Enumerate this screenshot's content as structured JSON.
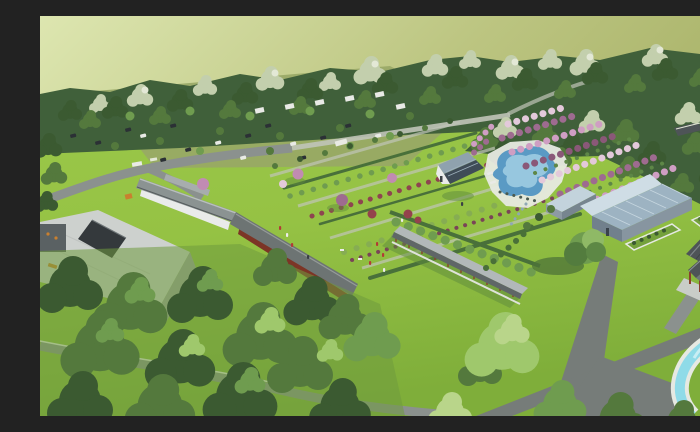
{
  "scene": {
    "type": "aerial-architectural-rendering",
    "description": "Bird's-eye architectural rendering of a landscaped park resort: pale olive sky haze, dense tree belt with wooded parking grove, formal lawn gardens with diagonal hedge and flower rows, kidney-shaped swimming pool surrounded by rows of pink and mauve flowering shrubs, gray flat-roof hall with dark courtyard opening, traditional tiled-roof corridor buildings, blue-gray gabled greenhouse hall, long covered walkway with red posts, red-column pavilion, curving cyan stream pool at lower right, and large green tree canopies at lower left.",
    "visible_text": []
  },
  "palette": {
    "hazeLight": "#dde6b0",
    "hazeMid": "#bcc581",
    "hazeDark": "#a6b065",
    "treeDark": "#3b5a31",
    "treeMid": "#54793d",
    "leafLight": "#6f9c4f",
    "canopyBright": "#9fc86c",
    "canopyPale": "#b9d58a",
    "sage": "#c3cfad",
    "sageLight": "#e3e8d6",
    "forestBase": "#40603a",
    "lawnBright": "#a5d14e",
    "lawnMid": "#8dbc3e",
    "lawnShade": "#74a13c",
    "lawnDeepShade": "#5d8a3b",
    "parkGround": "#98a766",
    "pathGray": "#8b918e",
    "pathDark": "#767c79",
    "pathPale": "#c0c4b8",
    "curbWhite": "#e6e9e2",
    "roofFlat": "#cdd1ce",
    "wallGray": "#9ea3a1",
    "courtyardDark": "#34393c",
    "tileRoof": "#8b9392",
    "tileRoofDark": "#6d7473",
    "tileRidge": "#b9bfbe",
    "corridorTop": "#b2b8b9",
    "corridorFace": "#5f6667",
    "pavRoofDark": "#4e5457",
    "pavRoofLight": "#6e767a",
    "redWood": "#8a402d",
    "redWall": "#7c3526",
    "houseRoofDark": "#3f4c57",
    "houseRoofLight": "#8fa2ae",
    "glassRoof": "#9db3c2",
    "glassRoofLight": "#cfdde5",
    "glassWall": "#8795a0",
    "whiteWall": "#e9ebea",
    "deckWhite": "#e7eae1",
    "poolBlue": "#5a9ac4",
    "poolLight": "#a6d2e6",
    "streamCyan": "#8fdbe8",
    "streamLight": "#c8eef4",
    "bloomPink": "#cf9ec3",
    "bloomMauve": "#9e6b90",
    "bloomDeep": "#8a5878",
    "bloomPale": "#e3c9da",
    "pinkTree": "#c18bb2",
    "redShrub": "#94424c",
    "purpleShrub": "#7a4457",
    "redRow": "#8e4450",
    "hedgeDark": "#49703a",
    "accentOrange": "#c9802f",
    "carDark": "#2b3035",
    "carWhite": "#e9eae6",
    "personRed": "#b23b35",
    "personWhite": "#ececea",
    "personDark": "#3a4044"
  },
  "elements": [
    {
      "name": "haze-sky",
      "desc": "pale yellow-green distant haze"
    },
    {
      "name": "tree-belt",
      "desc": "mixed sage and dark green tree line across the top"
    },
    {
      "name": "parking-grove",
      "desc": "wooded parking area with scattered cars and cabins"
    },
    {
      "name": "access-road",
      "desc": "curved gray road entering from the left"
    },
    {
      "name": "flat-roof-building",
      "desc": "gray flat-roof hall with dark square courtyard opening"
    },
    {
      "name": "traditional-corridor-building",
      "desc": "long tiled-roof traditional building running diagonally"
    },
    {
      "name": "formal-garden",
      "desc": "lawn panels with diagonal hedge, shrub and red flower rows"
    },
    {
      "name": "garden-house",
      "desc": "small dark-roof house with white gable near the pool"
    },
    {
      "name": "swimming-pool",
      "desc": "kidney-shaped blue pool with white deck"
    },
    {
      "name": "bloom-field",
      "desc": "diagonal rows of pink and mauve flowering shrubs"
    },
    {
      "name": "greenhouse-hall",
      "desc": "large L-shaped building with blue-gray panel roof"
    },
    {
      "name": "covered-walkway",
      "desc": "long corridor with gray roof and red posts"
    },
    {
      "name": "shrub-row",
      "desc": "row of round clipped shrubs behind the walkway"
    },
    {
      "name": "lone-tree",
      "desc": "large single tree with cast shadow"
    },
    {
      "name": "pavilion",
      "desc": "red-column pavilion with dark gabled roof at right"
    },
    {
      "name": "stream-pool",
      "desc": "curving cyan water channel with white edging at lower right"
    },
    {
      "name": "canopy-bottom-left",
      "desc": "dense green tree canopies over shaded lawn"
    },
    {
      "name": "paths",
      "desc": "gray pedestrian paths crossing the lawns"
    },
    {
      "name": "visitors",
      "desc": "tiny human figures on the lawns"
    }
  ]
}
